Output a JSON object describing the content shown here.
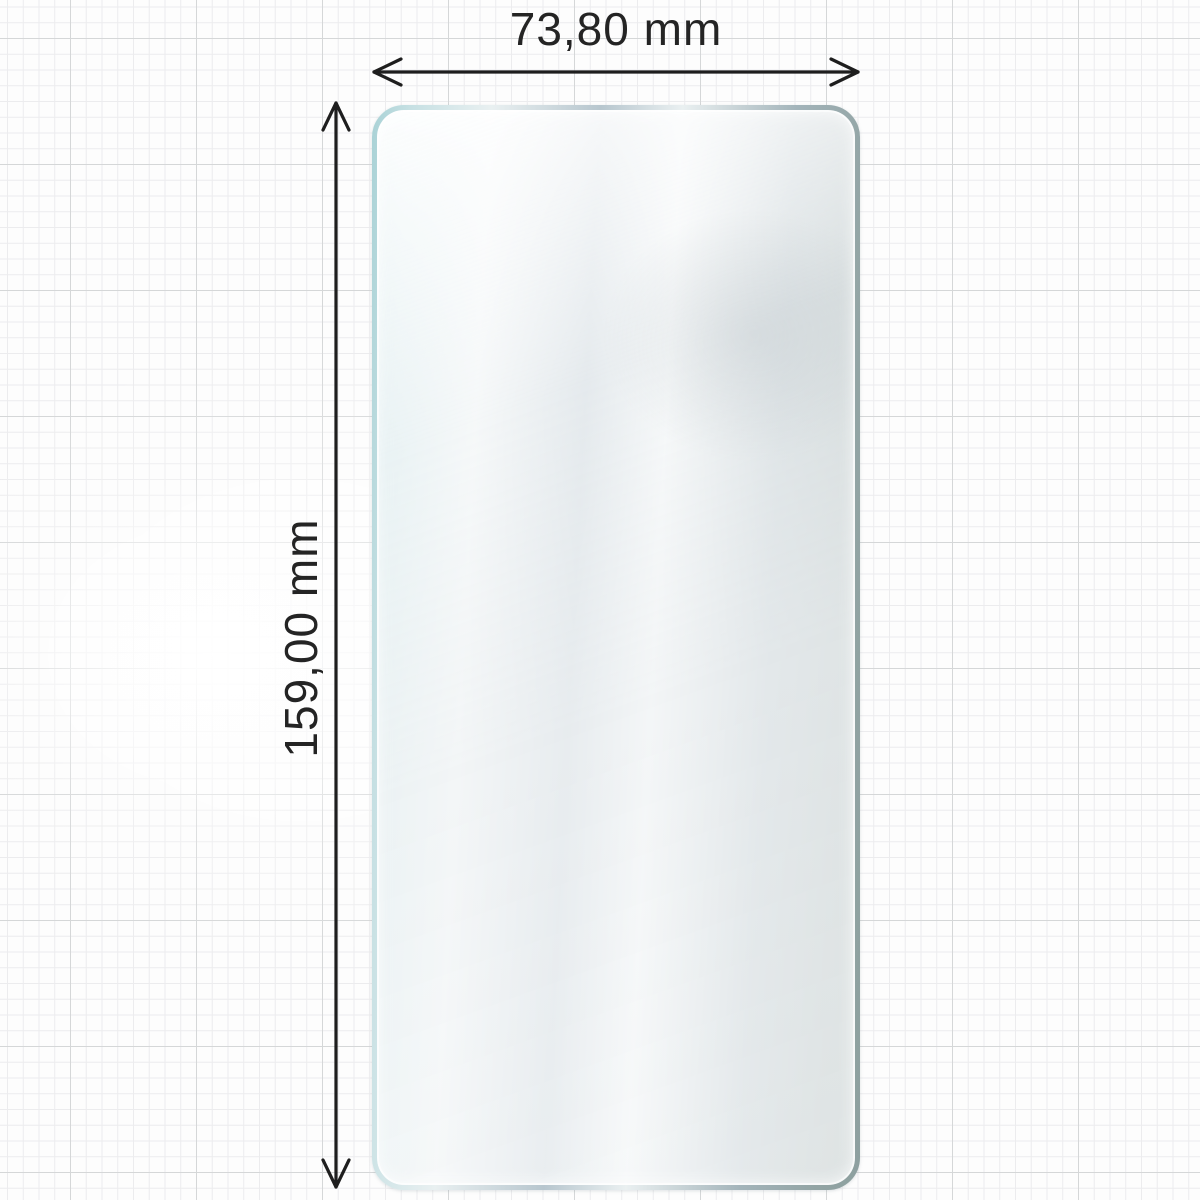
{
  "figure": {
    "type": "product-dimension-diagram",
    "subject": "screen-protector-film"
  },
  "dimensions": {
    "width": {
      "label": "73,80 mm"
    },
    "height": {
      "label": "159,00 mm"
    }
  },
  "style": {
    "dimension_line_color": "#1e1e1e",
    "glass_edge_cyan": "#a9d2d6",
    "glass_edge_steel": "#b7c6ce",
    "glass_edge_slate": "#8da09f",
    "grid_minor_color": "#ececee",
    "grid_major_color": "#d5d7d8",
    "background_color": "#fdfdfd"
  }
}
